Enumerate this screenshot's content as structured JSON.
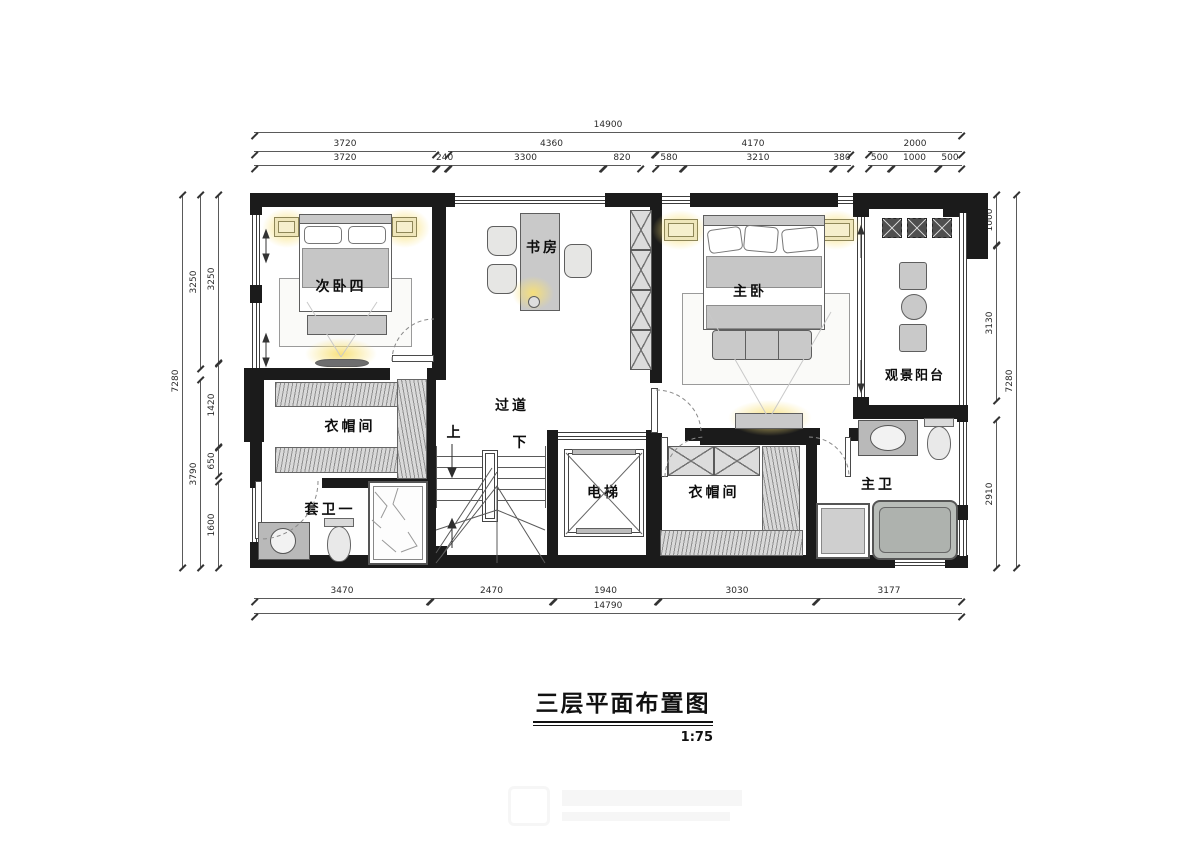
{
  "title": {
    "text": "三层平面布置图",
    "scale": "1:75"
  },
  "rooms": {
    "bedroom4": "次卧四",
    "study": "书房",
    "master_bedroom": "主卧",
    "view_balcony": "观景阳台",
    "closet_left": "衣帽间",
    "ensuite_bath1": "套卫一",
    "corridor": "过道",
    "elevator": "电梯",
    "closet_right": "衣帽间",
    "master_bath": "主卫",
    "stairs_up": "上",
    "stairs_down": "下"
  },
  "dims": {
    "top_total": "14900",
    "top_row2": [
      "3720",
      "4360",
      "4170",
      "2000"
    ],
    "top_row3": [
      "3720",
      "240",
      "3300",
      "820",
      "580",
      "3210",
      "380",
      "500",
      "1000",
      "500"
    ],
    "bottom_row": [
      "3470",
      "2470",
      "1940",
      "3030",
      "3177"
    ],
    "bottom_total": "14790",
    "left_total": "7280",
    "left_row2": [
      "3250",
      "3790"
    ],
    "left_row3": [
      "3250",
      "1420",
      "650",
      "1600"
    ],
    "right_row": [
      "1000",
      "3130",
      "2910"
    ],
    "right_total": "7280"
  }
}
